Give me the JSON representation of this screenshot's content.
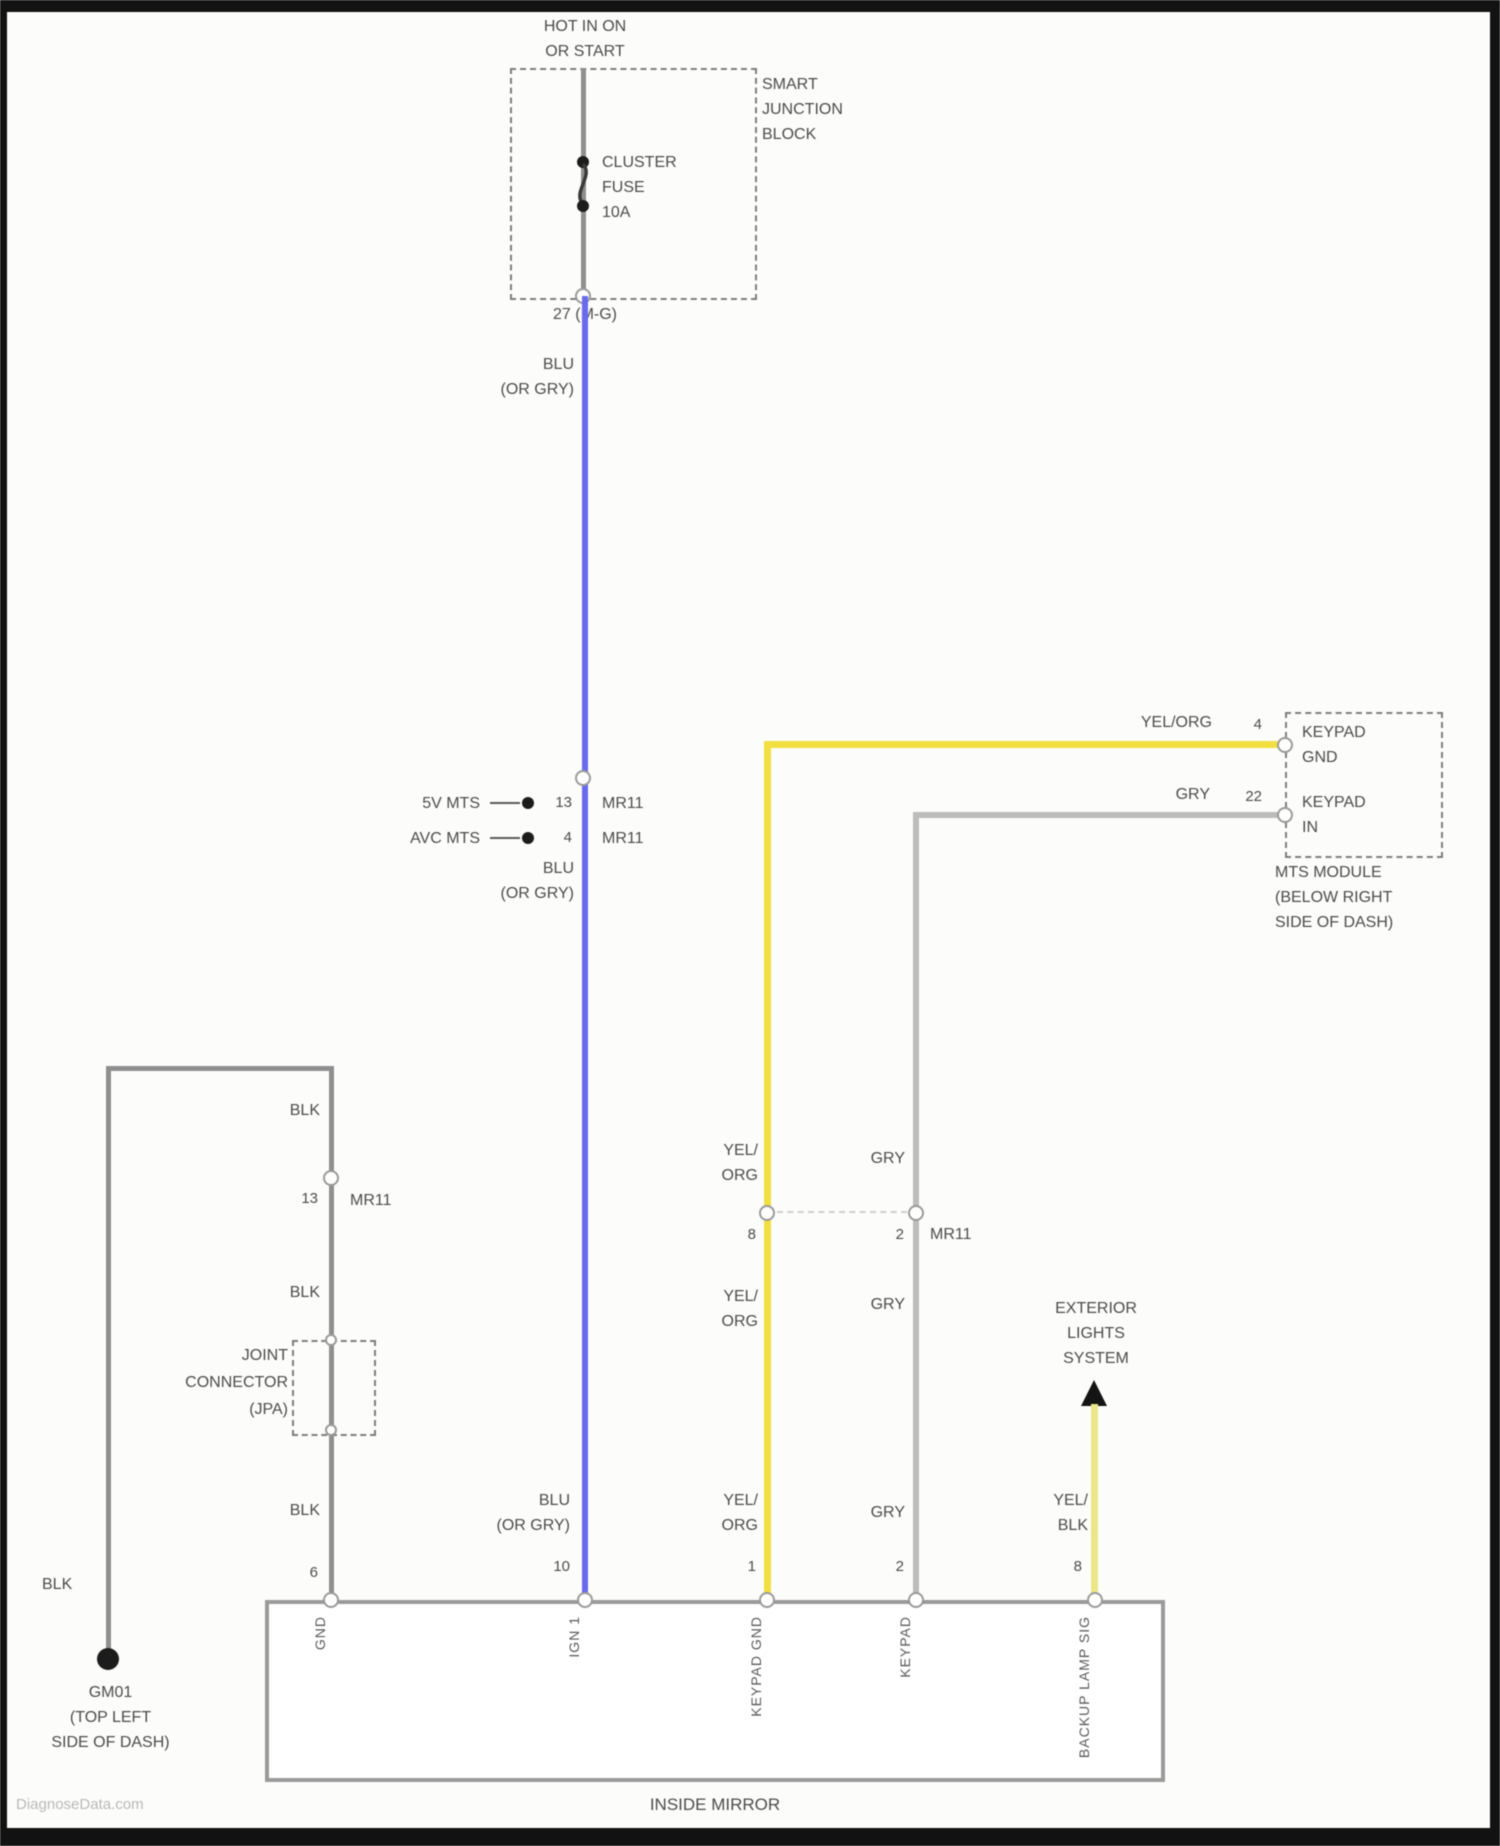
{
  "diagram": {
    "watermark": "DiagnoseData.com",
    "power_label": [
      "HOT IN ON",
      "OR START"
    ],
    "junction_block": {
      "name": [
        "SMART",
        "JUNCTION",
        "BLOCK"
      ],
      "fuse": [
        "CLUSTER",
        "FUSE",
        "10A"
      ],
      "out_pin": "27 (M-G)"
    },
    "labels": {
      "blu": [
        "BLU",
        "(OR GRY)"
      ],
      "yel2": [
        "YEL/",
        "ORG"
      ],
      "yelblk": [
        "YEL/",
        "BLK"
      ],
      "gry": "GRY",
      "blk": "BLK",
      "yel_org": "YEL/ORG"
    },
    "mid_splice": {
      "rows": [
        {
          "ref": "5V MTS",
          "pin": "13",
          "conn": "MR11"
        },
        {
          "ref": "AVC MTS",
          "pin": "4",
          "conn": "MR11"
        }
      ]
    },
    "mts_module": {
      "pin_a": {
        "num": "4",
        "name": [
          "KEYPAD",
          "GND"
        ]
      },
      "pin_b": {
        "num": "22",
        "name": [
          "KEYPAD",
          "IN"
        ]
      },
      "caption": [
        "MTS MODULE",
        "(BELOW RIGHT",
        "SIDE OF DASH)"
      ]
    },
    "left_branch": {
      "conn_pin": "13",
      "conn": "MR11",
      "joint_connector": [
        "JOINT",
        "CONNECTOR",
        "(JPA)"
      ],
      "ground": [
        "GM01",
        "(TOP LEFT",
        "SIDE OF DASH)"
      ]
    },
    "mr11_mid": {
      "pin_yel": "8",
      "pin_gry": "2",
      "conn": "MR11"
    },
    "exterior_lights": [
      "EXTERIOR",
      "LIGHTS",
      "SYSTEM"
    ],
    "mirror": {
      "caption": "INSIDE MIRROR",
      "pins": [
        {
          "num": "6",
          "name": "GND"
        },
        {
          "num": "10",
          "name": "IGN 1"
        },
        {
          "num": "1",
          "name": "KEYPAD GND"
        },
        {
          "num": "2",
          "name": "KEYPAD"
        },
        {
          "num": "8",
          "name": "BACKUP LAMP SIG"
        }
      ]
    },
    "colors": {
      "blu": "#6a6af0",
      "yel": "#f2df42",
      "gry": "#bcbcbc",
      "yelblk": "#eae789",
      "blk_wire": "#8f8f8f"
    }
  }
}
